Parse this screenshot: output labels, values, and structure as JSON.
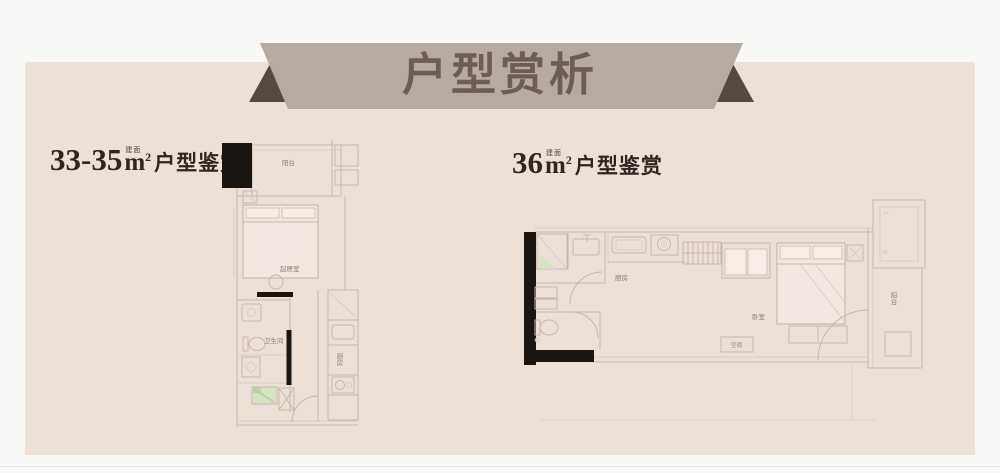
{
  "banner": {
    "title": "户型赏析"
  },
  "plans": {
    "left": {
      "heading": {
        "area": "33-35",
        "unit_note": "建面",
        "unit_base": "m",
        "unit_sup": "2",
        "suffix": "户型鉴赏"
      },
      "rooms": {
        "balcony": "阳台",
        "living": "起居室",
        "bath": "卫生间",
        "kitchen": "厨房"
      }
    },
    "right": {
      "heading": {
        "area": "36",
        "unit_note": "建面",
        "unit_base": "m",
        "unit_sup": "2",
        "suffix": "户型鉴赏"
      },
      "rooms": {
        "kitchen": "厨房",
        "bedroom": "卧室",
        "balcony": "阳台",
        "ac": "空调"
      }
    }
  },
  "colors": {
    "page_bg": "#f8f8f7",
    "panel_bg": "#ede0d7",
    "banner_bg": "#b6aaa3",
    "banner_fold": "#564a40",
    "title_text": "#6d5e54",
    "heading_text": "#2e2620",
    "wall_black": "#1b1511",
    "plan_line": "#c6b7ac",
    "accent_green": "#cfe0b8",
    "label_text": "#8b7b6e"
  }
}
